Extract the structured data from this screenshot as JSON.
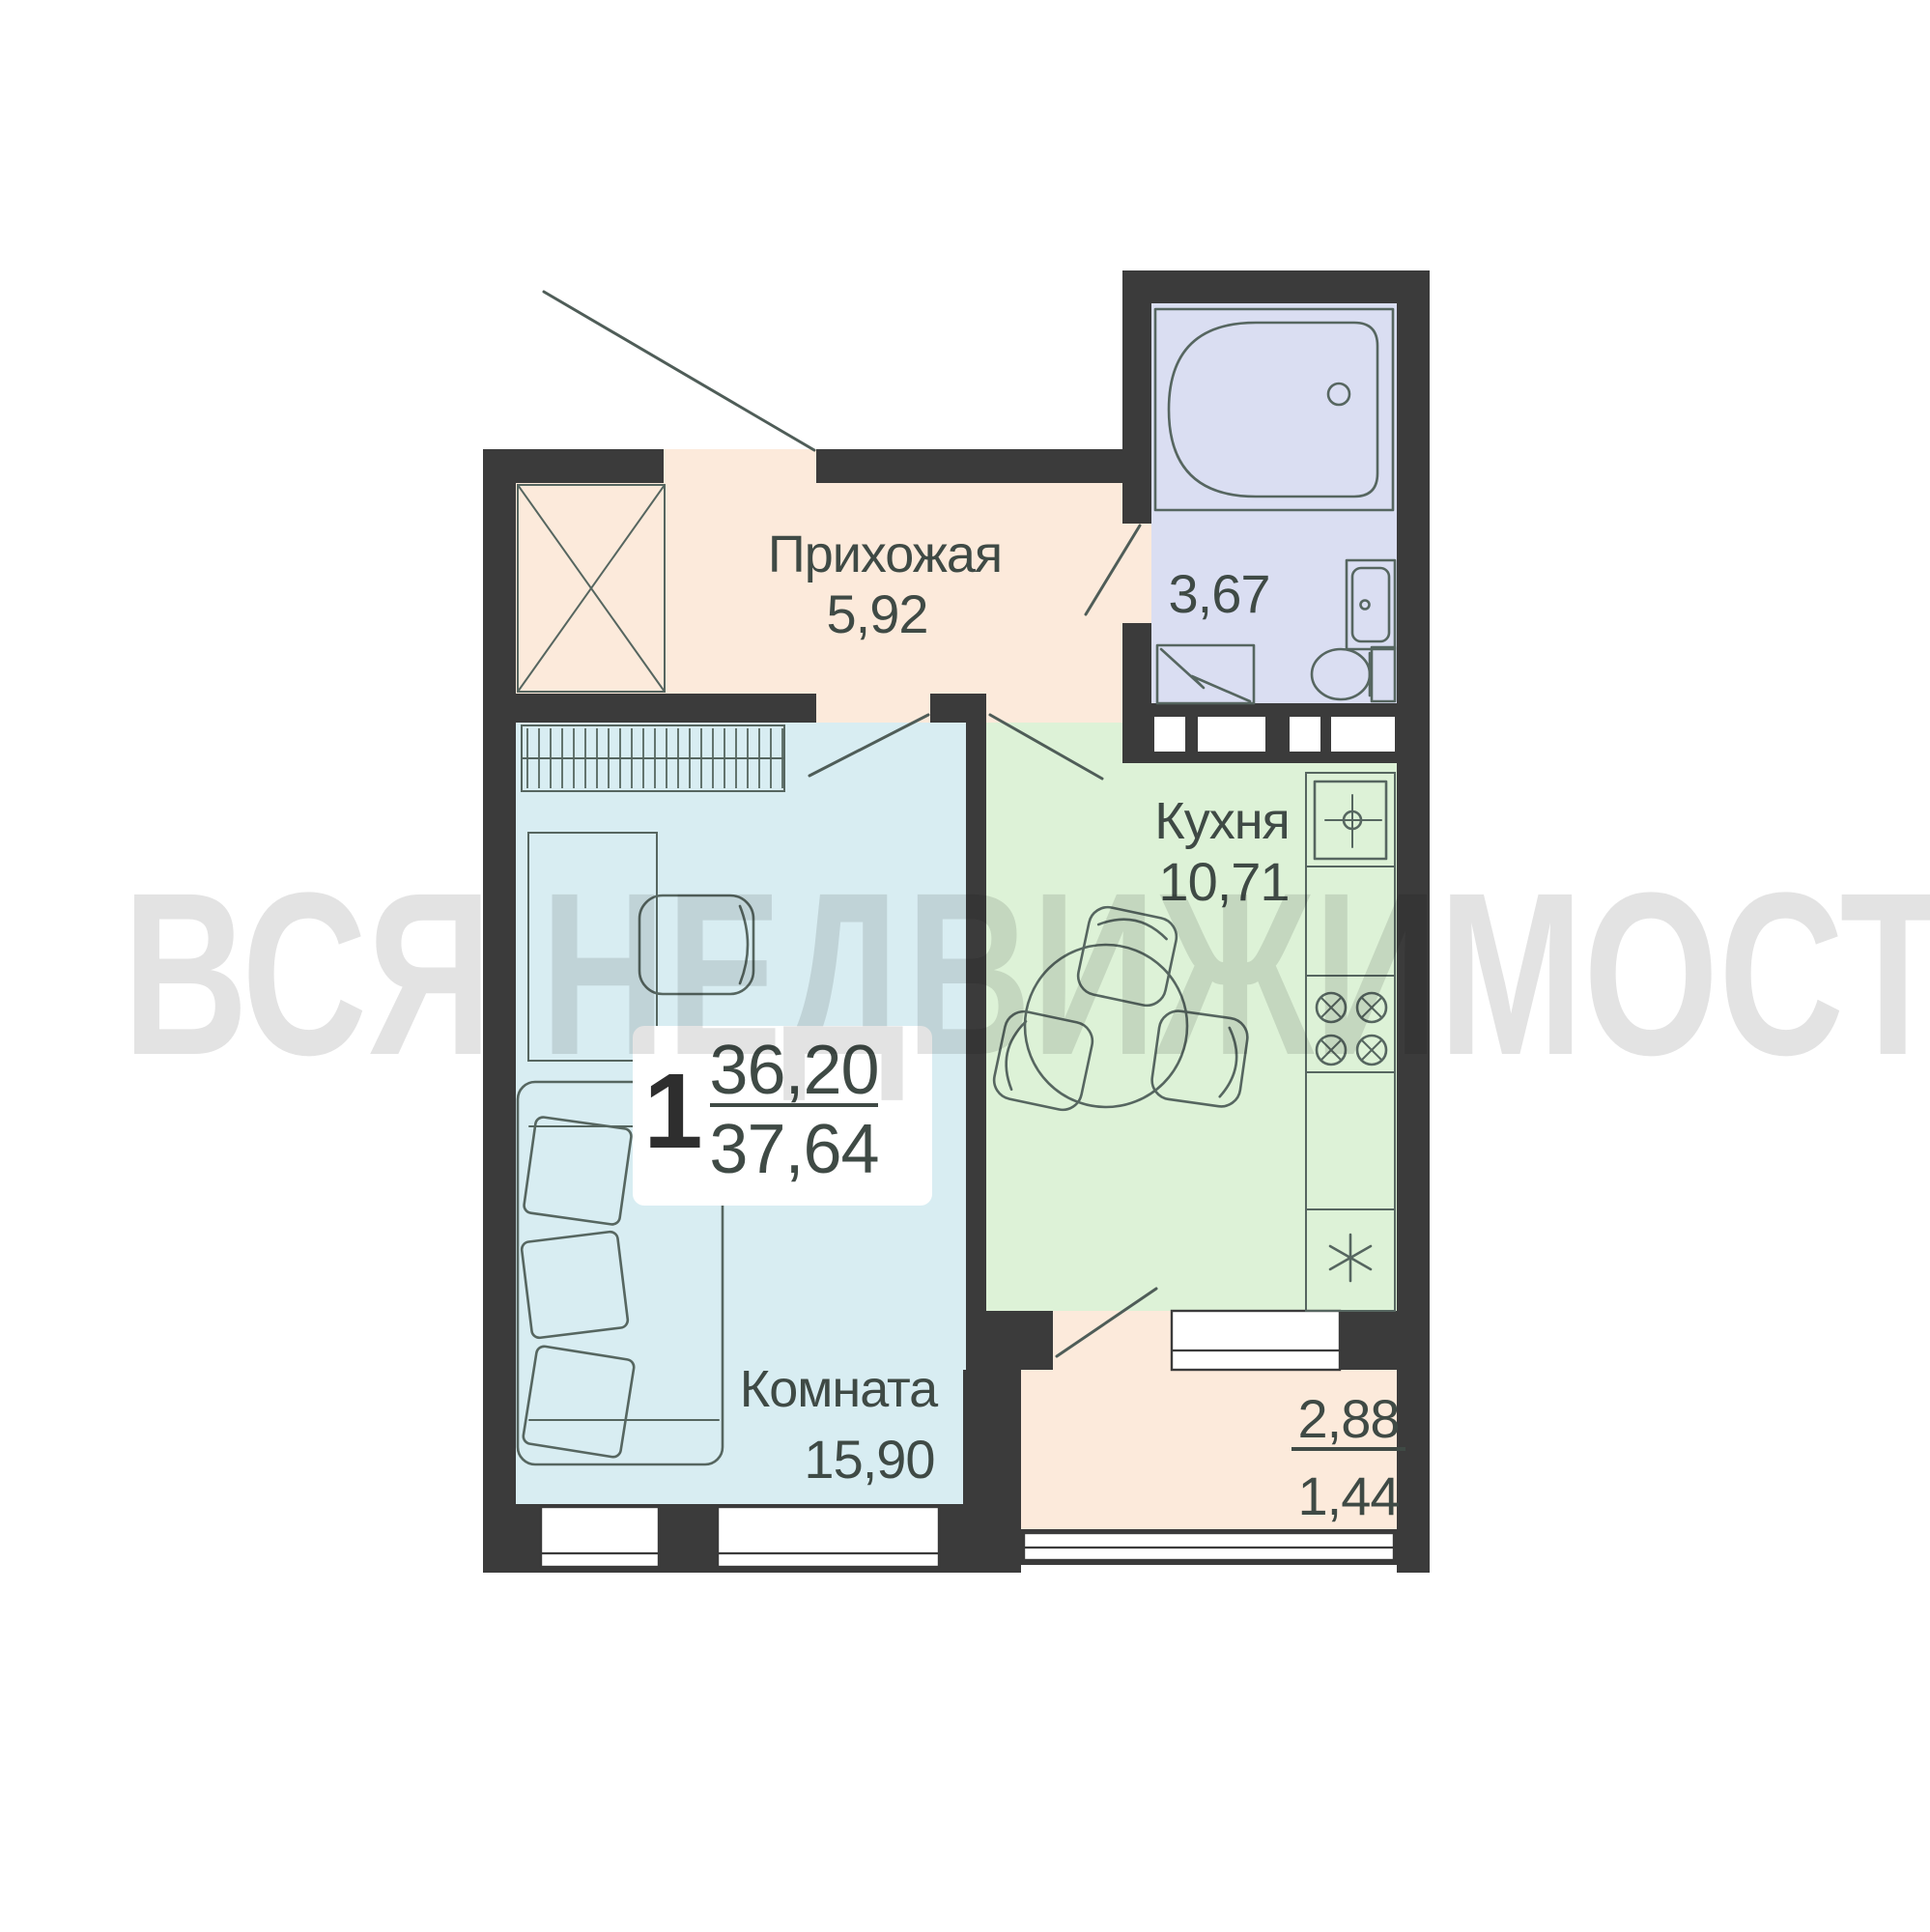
{
  "watermark": {
    "text": "ВСЯ НЕДВИЖИМОСТЬ",
    "color": "#e3e3e3"
  },
  "apartment": {
    "rooms_count": "1",
    "area_upper": "36,20",
    "area_lower": "37,64"
  },
  "rooms": {
    "hallway": {
      "label": "Прихожая",
      "area": "5,92"
    },
    "bathroom": {
      "area": "3,67"
    },
    "kitchen": {
      "label": "Кухня",
      "area": "10,71"
    },
    "living": {
      "label": "Комната",
      "area": "15,90"
    },
    "balcony": {
      "area_total": "2,88",
      "area_reduced": "1,44"
    }
  },
  "colors": {
    "wall": "#3b3b3b",
    "hallway_floor": "#fceadb",
    "living_floor": "#d8edf2",
    "kitchen_floor": "#ddf2d7",
    "bathroom_floor": "#dadef2",
    "balcony_floor": "#fceadb",
    "furniture_line": "#566660",
    "text": "#3f4a45"
  }
}
